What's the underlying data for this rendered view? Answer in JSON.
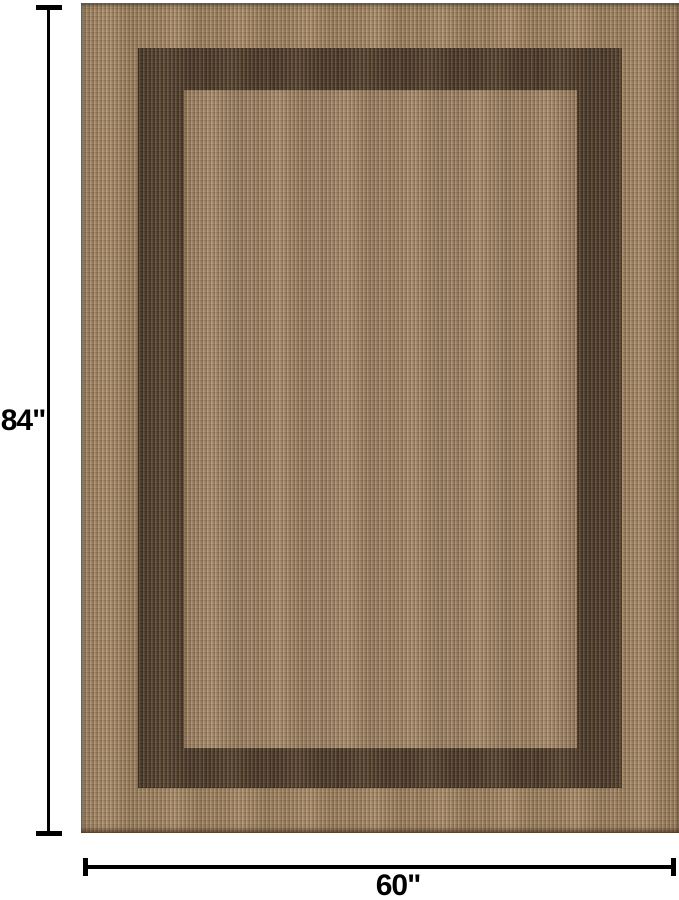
{
  "figure": {
    "description": "Flat-weave area rug with dark brown rectangular border band, annotated with dimension lines",
    "height_label": "84\"",
    "width_label": "60\""
  },
  "colors": {
    "background": "#ffffff",
    "dimension-line": "#000000",
    "label-text": "#000000",
    "rug-tan": "#a28768",
    "rug-dark-band": "#5b4937"
  }
}
